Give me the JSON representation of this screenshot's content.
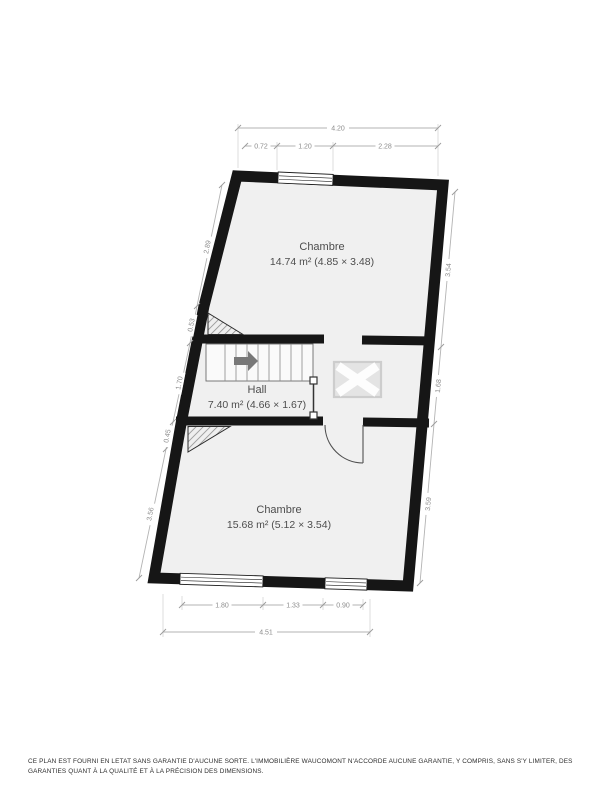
{
  "plan": {
    "rooms": [
      {
        "name": "Chambre",
        "area_line": "14.74 m² (4.85 × 3.48)"
      },
      {
        "name": "Hall",
        "area_line": "7.40 m² (4.66 × 1.67)"
      },
      {
        "name": "Chambre",
        "area_line": "15.68 m² (5.12 × 3.54)"
      }
    ],
    "dimensions": {
      "top_total": "4.20",
      "top_segments": [
        "0.72",
        "1.20",
        "2.28"
      ],
      "left_segments": [
        "2.89",
        "0.53",
        "1.70",
        "0.45",
        "3.56"
      ],
      "right_segments": [
        "3.54",
        "1.68",
        "3.59"
      ],
      "bottom_segments": [
        "1.80",
        "1.33",
        "0.90"
      ],
      "bottom_total": "4.51"
    },
    "symbols": {
      "stairs": "staircase-with-direction-arrow",
      "skylight": "skylight-x-box",
      "door": "door-swing-arc",
      "railing": "stair-railing",
      "hatching": "sloped-ceiling-hatch"
    },
    "colors": {
      "wall": "#161616",
      "floor": "#f0f0f0",
      "dimension_line": "#b3b3b3",
      "dimension_text": "#8c8c8c",
      "room_text": "#4d4d4d",
      "stair_arrow": "#787878"
    }
  },
  "footer": {
    "disclaimer": "CE PLAN EST FOURNI EN LETAT SANS GARANTIE D'AUCUNE SORTE. L'IMMOBILIÈRE WAUCOMONT N'ACCORDE AUCUNE GARANTIE, Y COMPRIS, SANS S'Y LIMITER, DES GARANTIES QUANT À LA QUALITÉ ET À LA PRÉCISION DES DIMENSIONS."
  }
}
